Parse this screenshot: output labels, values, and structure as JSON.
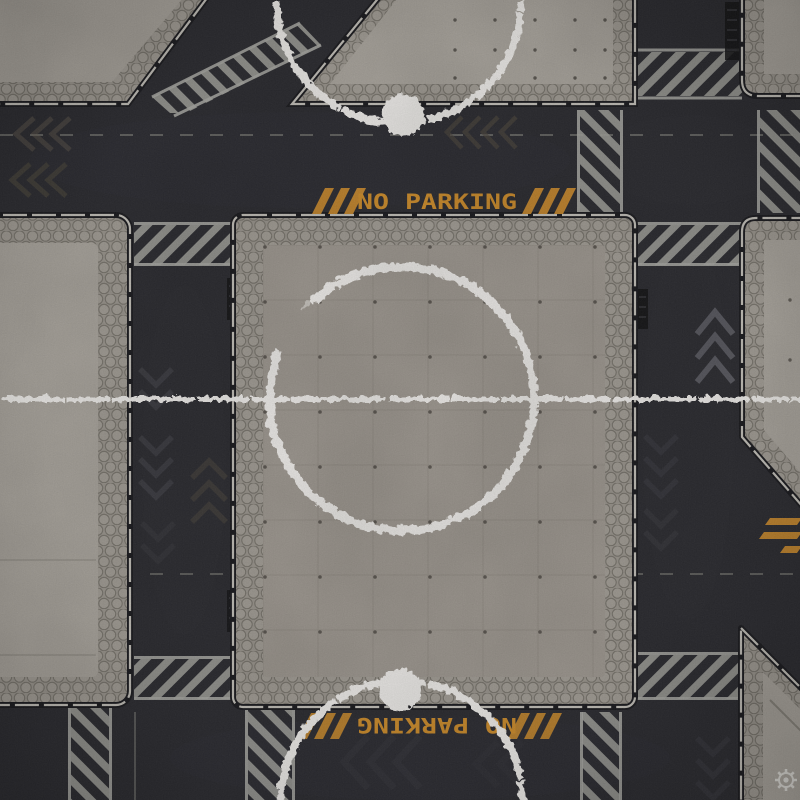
{
  "scene": {
    "kind": "top-down sci-fi urban battle-mat tile",
    "surfaces": "dark asphalt streets with raised concrete landing platforms",
    "colors": {
      "asphalt": "#28282d",
      "concrete": "#a9a49c",
      "hex_trim": "#99948c",
      "crosswalk_gray": "#a0a09b",
      "hazard_orange": "#c9882a",
      "paint_white": "#efedea"
    }
  },
  "signs": {
    "no_parking_top": "NO PARKING",
    "no_parking_bottom": "NO PARKING"
  },
  "markings": {
    "center_circle": "distressed white circle with full-width half line",
    "top_zone": "white semicircle arc with solid spot",
    "bottom_zone": "white semicircle arc with solid spot"
  },
  "logo": {
    "type": "gear watermark"
  }
}
